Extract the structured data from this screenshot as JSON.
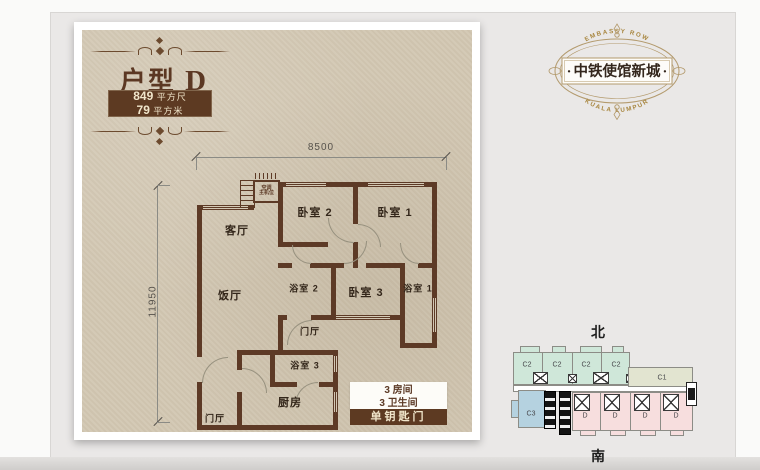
{
  "page": {
    "background": "#eae8e7",
    "card_paper": "#d3c8b4",
    "accent_brown": "#5d3a22"
  },
  "title_block": {
    "name": "户型",
    "variant": "D",
    "area1_value": "849",
    "area1_unit": "平方尺",
    "area2_value": "79",
    "area2_unit": "平方米"
  },
  "logo": {
    "arc_top": "EMBASSY ROW",
    "dot": "·",
    "name": "中铁使馆新城",
    "arc_bottom": "KUALA LUMPUR"
  },
  "floorplan": {
    "dim_top": "8500",
    "dim_left": "11950",
    "rooms": {
      "living": "客厅",
      "dining": "饭厅",
      "bed1": "卧室 1",
      "bed2": "卧室 2",
      "bed3": "卧室 3",
      "bath1": "浴室 1",
      "bath2": "浴室 2",
      "bath3": "浴室 3",
      "kitchen": "厨房",
      "hall_mid": "门厅",
      "hall_entry": "门厅",
      "ac_line1": "空调",
      "ac_line2": "主机位"
    },
    "info": {
      "line1": "3 房间",
      "line2": "3 卫生间",
      "banner": "单钥匙门"
    }
  },
  "keyplan": {
    "north": "北",
    "south": "南",
    "top_units": [
      "C2",
      "C2",
      "C2",
      "C2"
    ],
    "side_unit": "C1",
    "corner_unit": "C3",
    "bottom_units": [
      "D",
      "D",
      "D",
      "D"
    ]
  }
}
